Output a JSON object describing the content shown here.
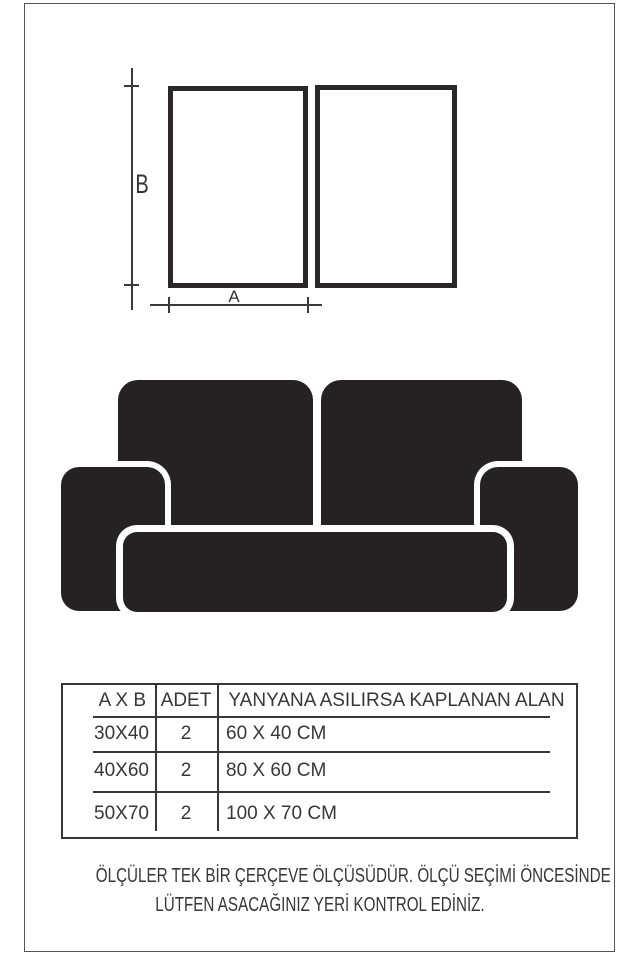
{
  "colors": {
    "ink": "#39363b",
    "shape_black": "#262123",
    "frame_border": "#2b2728",
    "page_border": "#53545a",
    "background": "#ffffff"
  },
  "diagram": {
    "height_label": "B",
    "width_label": "A",
    "frame_count": 2
  },
  "sofa": {
    "parts": [
      "back-cushion-left",
      "back-cushion-right",
      "armrest-left",
      "armrest-right",
      "seat-cushion"
    ]
  },
  "table": {
    "headers": [
      "A X B",
      "ADET",
      "YANYANA ASILIRSA KAPLANAN ALAN"
    ],
    "rows": [
      {
        "size": "30X40",
        "qty": "2",
        "area": "60 X 40 CM"
      },
      {
        "size": "40X60",
        "qty": "2",
        "area": "80 X 60 CM"
      },
      {
        "size": "50X70",
        "qty": "2",
        "area": "100 X 70 CM"
      }
    ]
  },
  "caption": {
    "line1": "ÖLÇÜLER TEK BİR ÇERÇEVE ÖLÇÜSÜDÜR. ÖLÇÜ SEÇİMİ ÖNCESİNDE",
    "line2": "LÜTFEN ASACAĞINIZ YERİ KONTROL EDİNİZ."
  }
}
